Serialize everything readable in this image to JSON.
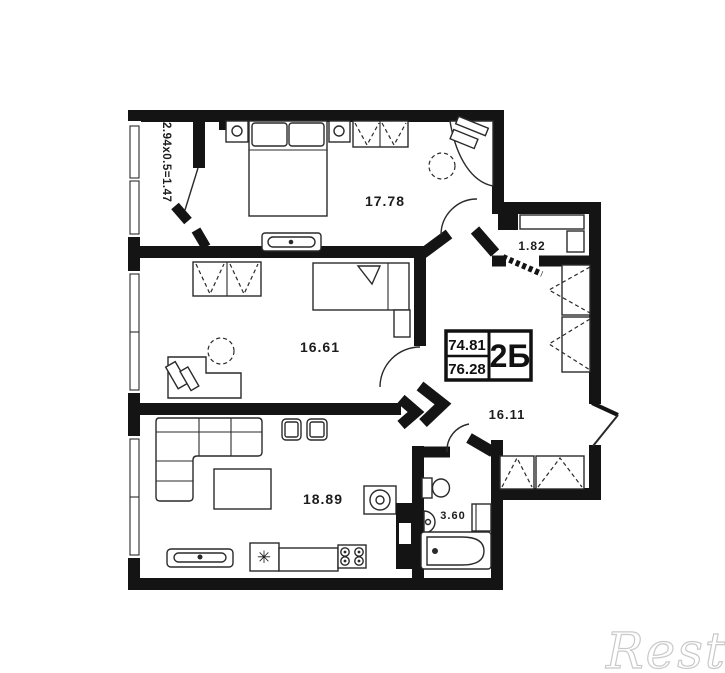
{
  "watermark": {
    "text": "Restate"
  },
  "title_block": {
    "value_top": "74.81",
    "value_bottom": "76.28",
    "unit_label": "2Б"
  },
  "rooms": {
    "bedroom1": {
      "name": "bedroom-1",
      "area": "17.78"
    },
    "bedroom2": {
      "name": "bedroom-2",
      "area": "16.61"
    },
    "living_kitchen": {
      "name": "living-kitchen",
      "area": "18.89"
    },
    "hallway": {
      "name": "hallway",
      "area": "16.11"
    },
    "bathroom": {
      "name": "bathroom",
      "area": "3.60"
    },
    "closet": {
      "name": "closet",
      "area": "1.82"
    },
    "balcony": {
      "name": "balcony",
      "dimensions": "2.94x0.5=1.47"
    }
  },
  "symbols": {
    "sink": "✳"
  },
  "colors": {
    "wall": "#141414",
    "line": "#2a2a2a",
    "background": "#ffffff",
    "watermark_stroke": "#c9c9c9"
  }
}
